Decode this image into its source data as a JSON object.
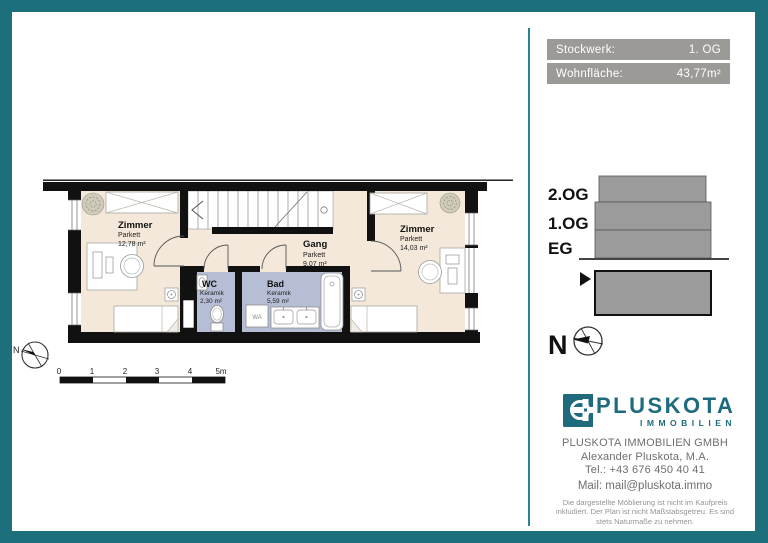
{
  "header": {
    "stockwerk_label": "Stockwerk:",
    "stockwerk_value": "1. OG",
    "wohnflaeche_label": "Wohnfläche:",
    "wohnflaeche_value": "43,77m²"
  },
  "floorplan": {
    "rooms": [
      {
        "name": "Zimmer",
        "floor": "Parkett",
        "area": "12,78 m²"
      },
      {
        "name": "Gang",
        "floor": "Parkett",
        "area": "9,07 m²"
      },
      {
        "name": "Zimmer",
        "floor": "Parkett",
        "area": "14,03 m²"
      },
      {
        "name": "WC",
        "floor": "Keramik",
        "area": "2,30 m²"
      },
      {
        "name": "Bad",
        "floor": "Keramik",
        "area": "5,59 m²"
      }
    ],
    "washer_label": "WA",
    "north_label": "N",
    "scale_ticks": [
      "0",
      "1",
      "2",
      "3",
      "4",
      "5m"
    ]
  },
  "section": {
    "levels": [
      "2.OG",
      "1.OG",
      "EG"
    ],
    "north_label": "N"
  },
  "branding": {
    "logo_name": "PLUSKOTA",
    "logo_sub": "IMMOBILIEN",
    "company": "PLUSKOTA IMMOBILIEN GMBH",
    "contact_name": "Alexander Pluskota, M.A.",
    "phone": "Tel.: +43 676 450 40 41",
    "mail": "Mail: mail@pluskota.immo",
    "disclaimer": "Die dargestellte Möblierung ist nicht im Kaufpreis inkludiert. Der Plan ist nicht Maßstabsgetreu. Es sind stets Naturmaße zu nehmen."
  },
  "colors": {
    "teal": "#1e6f7c",
    "divider": "#2a8292",
    "bar_gray": "#9c9a97",
    "floor_cream": "#f3e8da",
    "bath_blue": "#b5bed5",
    "section_gray": "#9b9b9b",
    "logo_teal": "#1d6b7c",
    "text_gray": "#6e6e6e"
  }
}
